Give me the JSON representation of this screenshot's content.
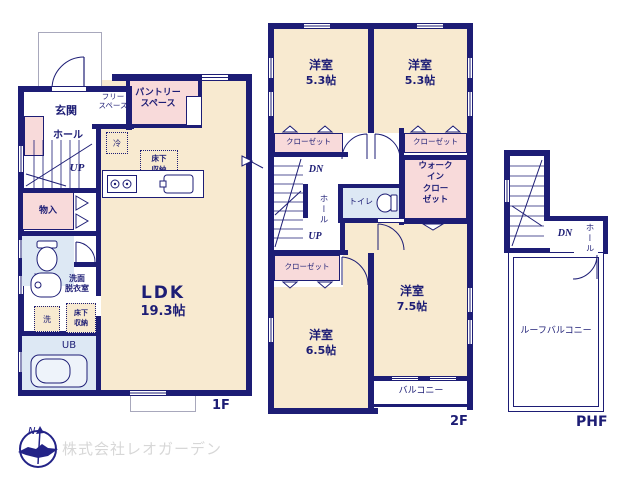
{
  "colors": {
    "wall_navy": "#1d1d75",
    "room_cream": "#f8ead0",
    "room_pink": "#f8dada",
    "room_blue": "#dde8f4",
    "outline_gray": "#a8a8bc",
    "watermark_gray": "#d7d7d7",
    "logo_blue": "#232387"
  },
  "floor1": {
    "floor_label": "1F",
    "genkan": "玄関",
    "free_space": "フリー\nスペース",
    "pantry": "パントリー\nスペース",
    "hall": "ホール",
    "fridge": "冷",
    "underfloor_storage_kitchen": "床下\n収納",
    "up": "UP",
    "storage": "物入",
    "toilet": "トイレ",
    "washroom": "洗面\n脱衣室",
    "laundry": "洗",
    "underfloor_storage_wash": "床下\n収納",
    "unit_bath": "UB",
    "ldk_name": "LDK",
    "ldk_size": "19.3帖"
  },
  "floor2": {
    "floor_label": "2F",
    "room_nw_name": "洋室",
    "room_nw_size": "5.3帖",
    "room_ne_name": "洋室",
    "room_ne_size": "5.3帖",
    "room_se_name": "洋室",
    "room_se_size": "7.5帖",
    "room_sw_name": "洋室",
    "room_sw_size": "6.5帖",
    "closet_nw": "クローゼット",
    "closet_ne": "クローゼット",
    "closet_sw": "クローゼット",
    "walk_in_closet": "ウォーク\nイン\nクロー\nゼット",
    "dn": "DN",
    "up": "UP",
    "hall": "ホール",
    "toilet": "トイレ",
    "balcony": "バルコニー"
  },
  "phf": {
    "floor_label": "PHF",
    "dn": "DN",
    "hall": "ホール",
    "roof_balcony": "ルーフバルコニー"
  },
  "footer": {
    "company_name": "株式会社レオガーデン",
    "compass_letter": "N"
  }
}
